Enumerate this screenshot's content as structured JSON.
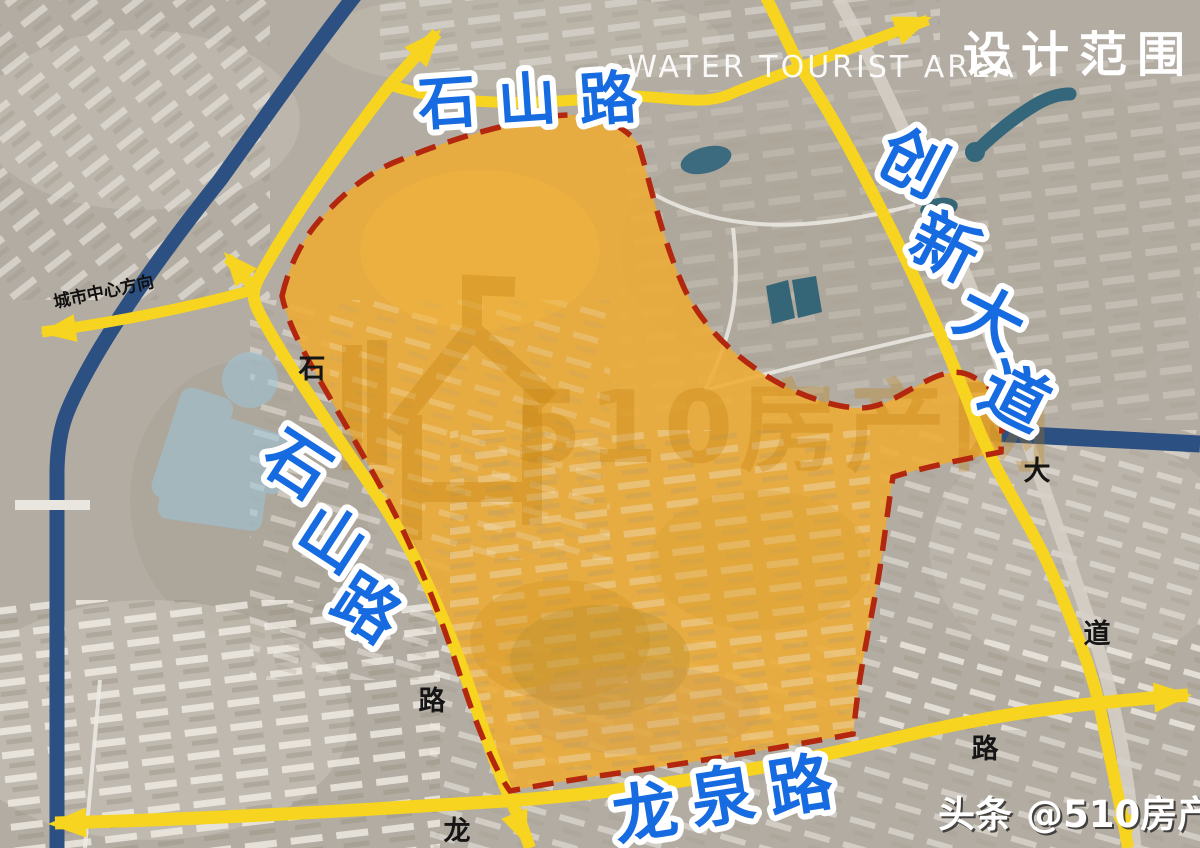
{
  "header": {
    "area_label": "WATER TOURIST AREA",
    "scope_label": "设计范围"
  },
  "roads": {
    "shishan_top": {
      "name": "石山路",
      "chars": [
        "石",
        "山",
        "路"
      ]
    },
    "shishan_left": {
      "name": "石山路",
      "chars": [
        "石",
        "山",
        "路"
      ]
    },
    "chuangxin": {
      "name": "创新大道",
      "chars": [
        "创",
        "新",
        "大",
        "道"
      ]
    },
    "longquan": {
      "name": "龙泉路",
      "chars": [
        "龙",
        "泉",
        "路"
      ]
    }
  },
  "map_labels": {
    "direction": "城市中心方向",
    "shi": "石",
    "lu_mid": "路",
    "long_small": "龙",
    "lu_east": "路",
    "da": "大",
    "dao": "道"
  },
  "watermark": {
    "brand": "510房产网"
  },
  "credit": {
    "source": "头条",
    "handle": "@510房产网"
  },
  "colors": {
    "design_area_fill": "#eeab33",
    "boundary_red": "#b3270e",
    "road_yellow": "#f6d41f",
    "water_navy": "#2d5082",
    "pond_teal": "#356677",
    "label_blue": "#176be0"
  }
}
